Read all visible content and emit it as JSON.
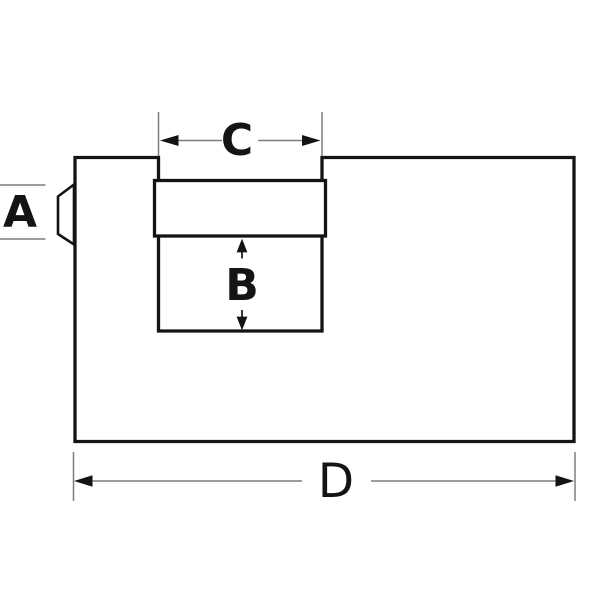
{
  "diagram": {
    "type": "technical-dimension-diagram",
    "dimensions": {
      "a": {
        "label": "A"
      },
      "b": {
        "label": "B"
      },
      "c": {
        "label": "C"
      },
      "d": {
        "label": "D"
      }
    },
    "colors": {
      "background": "#ffffff",
      "outline": "#141414",
      "dimension_line": "#7d7d7d",
      "label_text": "#141414"
    }
  }
}
